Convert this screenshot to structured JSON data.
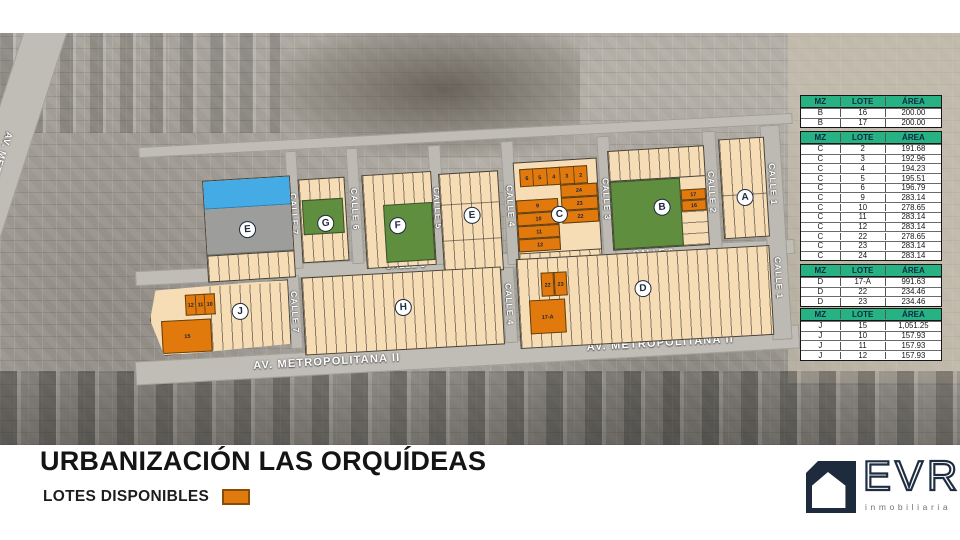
{
  "title": "URBANIZACIÓN LAS ORQUÍDEAS",
  "legend": {
    "label": "LOTES DISPONIBLES",
    "available_color": "#e0790e"
  },
  "logo": {
    "brand": "EVR",
    "subtitle": "inmobiliaria"
  },
  "map": {
    "streets": {
      "av1": "AV. METROPOLITANA I",
      "av2": "AV. METROPOLITANA II",
      "calle9": "CALLE 9",
      "calle7": "CALLE 7",
      "calle6": "CALLE 6",
      "calle5": "CALLE 5",
      "calle4": "CALLE 4",
      "calle3": "CALLE 3",
      "calle2": "CALLE 2",
      "calle1": "CALLE 1"
    },
    "blocks": {
      "e1": "E",
      "g": "G",
      "f": "F",
      "e2": "E",
      "c": "C",
      "b": "B",
      "a": "A",
      "j": "J",
      "h": "H",
      "d": "D"
    },
    "lots": {
      "c_top": [
        "6",
        "5",
        "4",
        "3",
        "2"
      ],
      "c_right": [
        "24",
        "23",
        "22"
      ],
      "c_left": [
        "9",
        "10",
        "11",
        "12"
      ],
      "b_right": [
        "17",
        "16"
      ],
      "d_top": [
        "22",
        "23"
      ],
      "d_big": "17-A",
      "j_top": [
        "12",
        "11",
        "10"
      ],
      "j_big": "15"
    }
  },
  "tables": [
    {
      "headers": [
        "MZ",
        "LOTE",
        "ÁREA"
      ],
      "rows": [
        [
          "B",
          "16",
          "200.00"
        ],
        [
          "B",
          "17",
          "200.00"
        ]
      ]
    },
    {
      "headers": [
        "MZ",
        "LOTE",
        "ÁREA"
      ],
      "rows": [
        [
          "C",
          "2",
          "191.68"
        ],
        [
          "C",
          "3",
          "192.96"
        ],
        [
          "C",
          "4",
          "194.23"
        ],
        [
          "C",
          "5",
          "195.51"
        ],
        [
          "C",
          "6",
          "196.79"
        ],
        [
          "C",
          "9",
          "283.14"
        ],
        [
          "C",
          "10",
          "278.65"
        ],
        [
          "C",
          "11",
          "283.14"
        ],
        [
          "C",
          "12",
          "283.14"
        ],
        [
          "C",
          "22",
          "278.65"
        ],
        [
          "C",
          "23",
          "283.14"
        ],
        [
          "C",
          "24",
          "283.14"
        ]
      ]
    },
    {
      "headers": [
        "MZ",
        "LOTE",
        "ÁREA"
      ],
      "rows": [
        [
          "D",
          "17-A",
          "991.63"
        ],
        [
          "D",
          "22",
          "234.46"
        ],
        [
          "D",
          "23",
          "234.46"
        ]
      ]
    },
    {
      "headers": [
        "MZ",
        "LOTE",
        "ÁREA"
      ],
      "rows": [
        [
          "J",
          "15",
          "1,051.25"
        ],
        [
          "J",
          "10",
          "157.93"
        ],
        [
          "J",
          "11",
          "157.93"
        ],
        [
          "J",
          "12",
          "157.93"
        ]
      ]
    }
  ]
}
